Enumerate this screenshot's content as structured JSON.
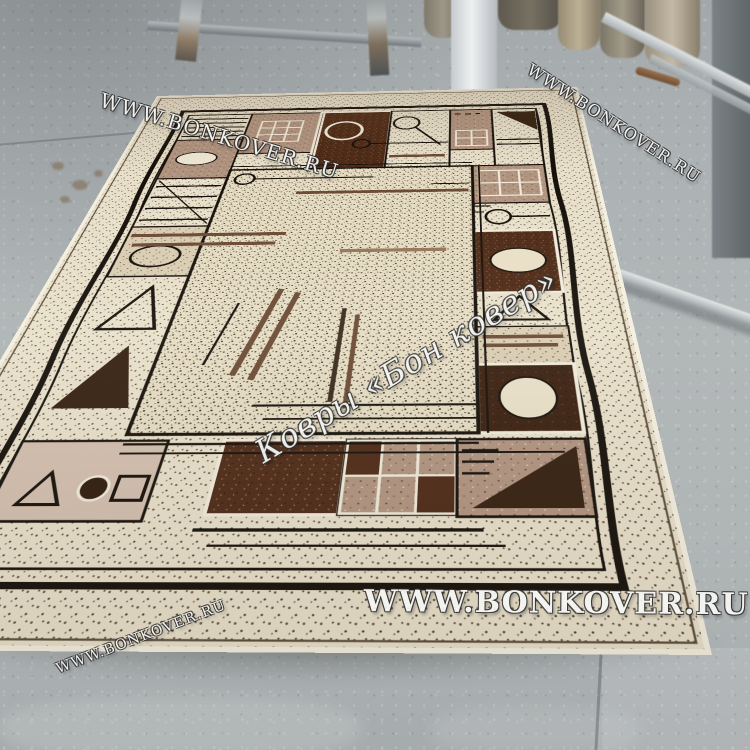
{
  "watermarks": {
    "url_text": "WWW.BONKOVER.RU",
    "brand_text": "Ковры «Бон ковер»"
  },
  "palette": {
    "floor_gray": "#b2b7b8",
    "floor_far": "#a2a7aa",
    "carpet_cream": "#e8e0ca",
    "carpet_beige": "#d9ccb2",
    "carpet_mauve": "#b19480",
    "carpet_brown_bar": "#6b4a33",
    "carpet_chocolate": "#4e2a16",
    "carpet_dark_brown": "#3a2010",
    "carpet_outline": "#16100a",
    "carpet_ivory": "#f1ebdb",
    "watermark_white": "#f5f5f3"
  }
}
